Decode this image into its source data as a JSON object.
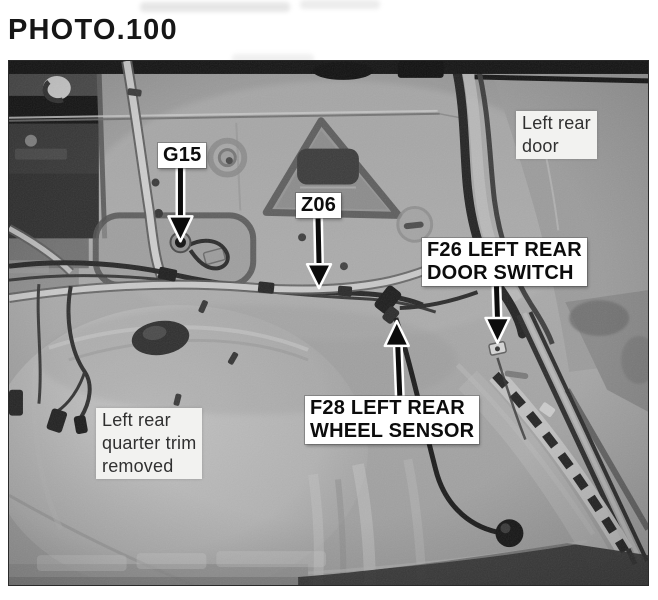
{
  "page": {
    "title": "PHOTO.100"
  },
  "photo": {
    "callouts": {
      "g15": {
        "label": "G15",
        "arrow": "down"
      },
      "z06": {
        "label": "Z06",
        "arrow": "down"
      },
      "f26": {
        "line1": "F26 LEFT REAR",
        "line2": "DOOR SWITCH",
        "arrow": "down"
      },
      "f28": {
        "line1": "F28 LEFT REAR",
        "line2": "WHEEL SENSOR",
        "arrow": "up"
      }
    },
    "notes": {
      "left_rear_door": {
        "line1": "Left rear",
        "line2": "door"
      },
      "quarter_trim": {
        "line1": "Left rear",
        "line2": "quarter trim",
        "line3": "removed"
      }
    }
  },
  "colors": {
    "page_background": "#ffffff",
    "heading_text": "#161616",
    "photo_border": "#2a2a2a",
    "callout_background": "#ffffff",
    "callout_text": "#0c0c0c",
    "note_background": "#f2f2f0",
    "note_text": "#303030",
    "arrow_color": "#0c0c0c",
    "arrow_outline": "#ffffff"
  }
}
